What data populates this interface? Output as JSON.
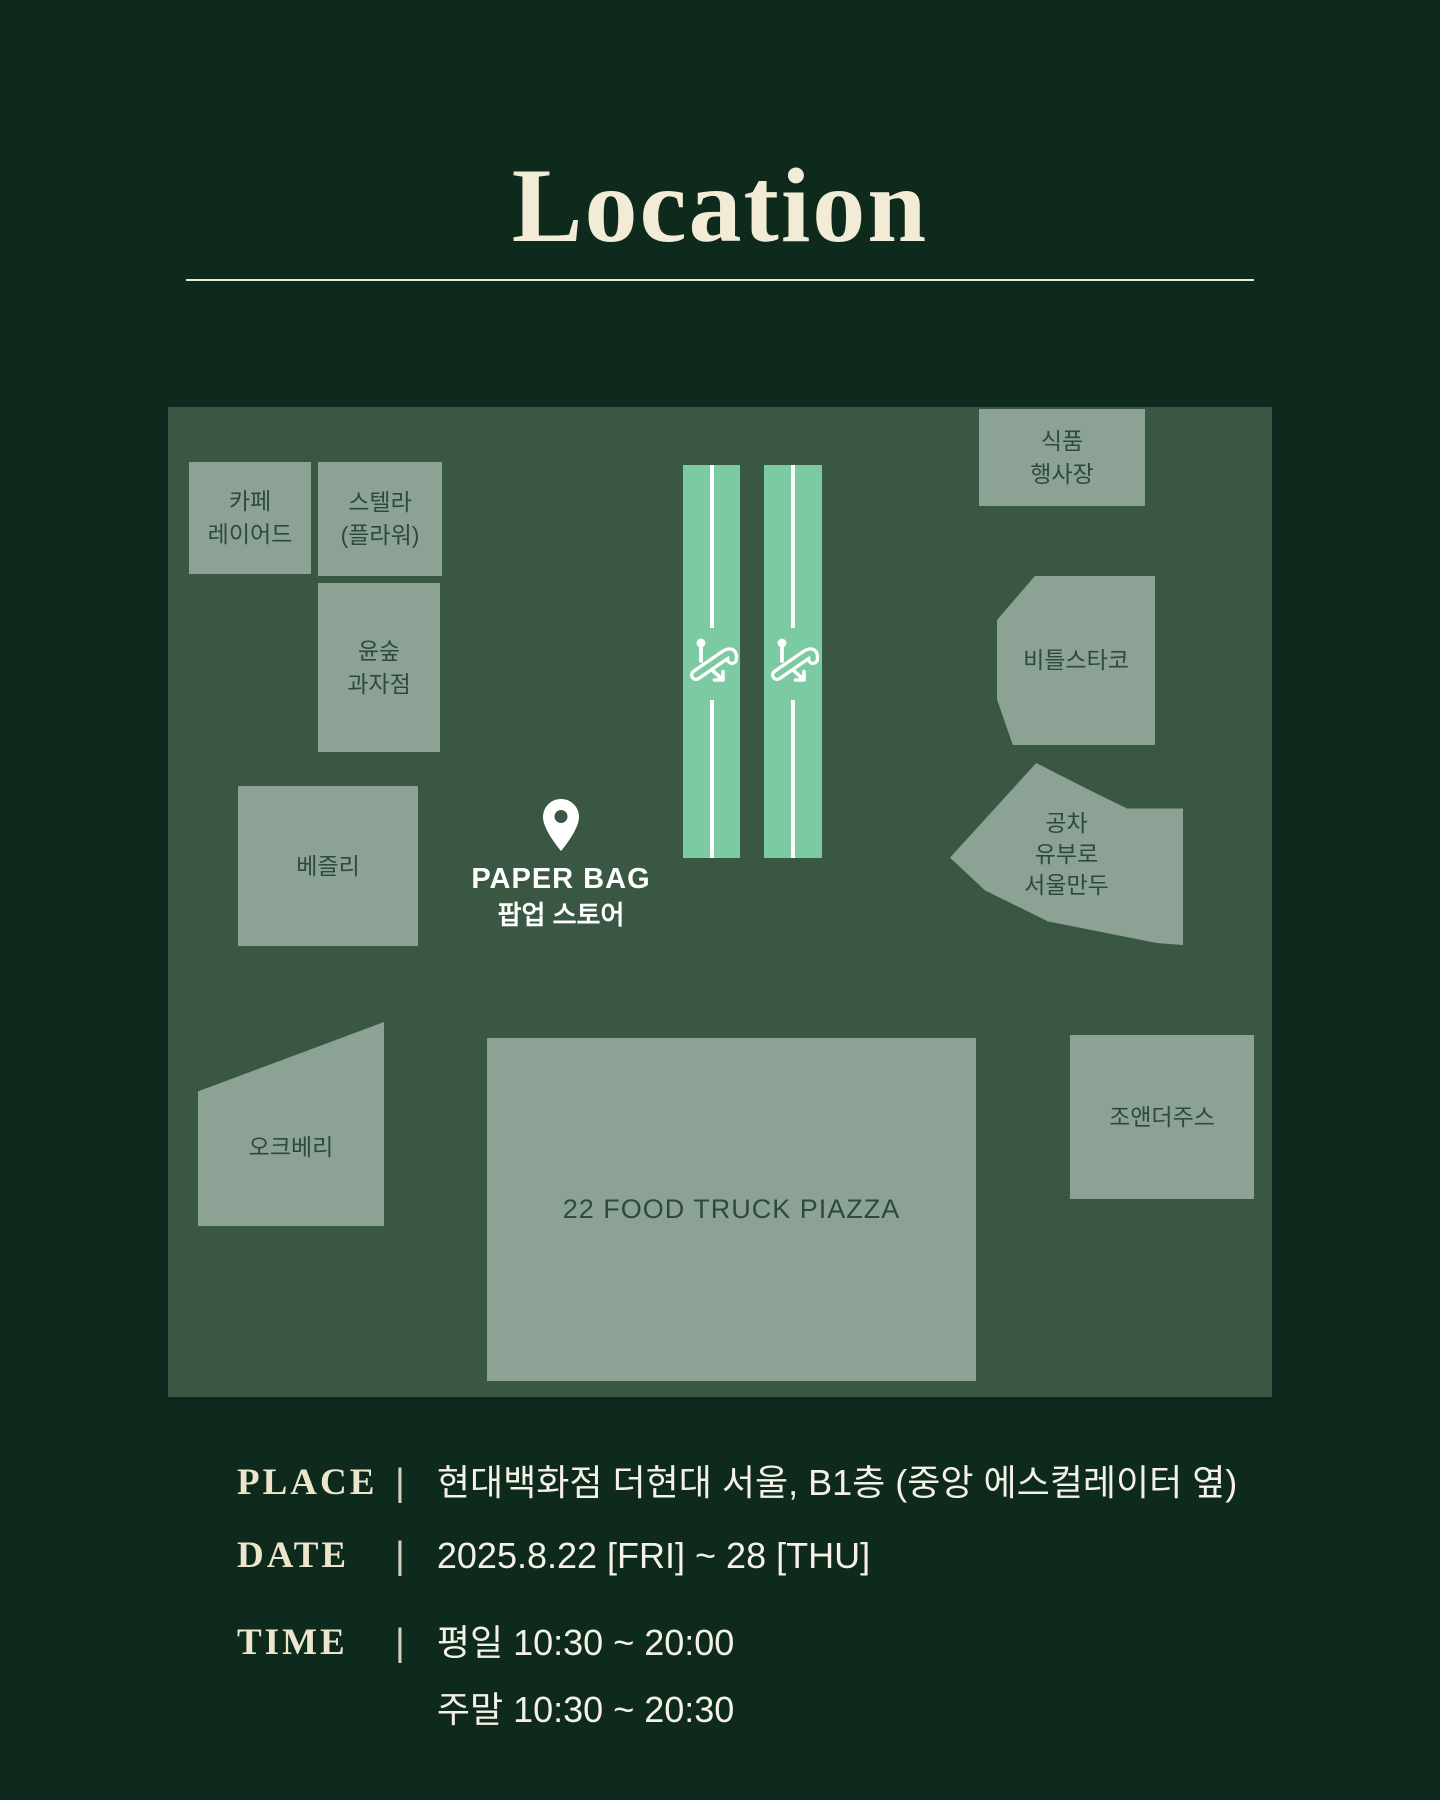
{
  "title": "Location",
  "colors": {
    "background": "#0d2a1c",
    "map_background": "#3a5744",
    "block_fill": "#8ba295",
    "block_text": "#2e4a3a",
    "escalator_fill": "#7ccaa1",
    "title_cream": "#f2ecd6",
    "info_text": "#f5f1e6"
  },
  "map": {
    "blocks": [
      {
        "id": "cafe-layered",
        "label": "카페\n레이어드"
      },
      {
        "id": "stella-flower",
        "label": "스텔라\n(플라워)"
      },
      {
        "id": "yoonsoop-bakery",
        "label": "윤숲\n과자점"
      },
      {
        "id": "bezzly",
        "label": "베즐리"
      },
      {
        "id": "oakberry",
        "label": "오크베리"
      },
      {
        "id": "food-event-hall",
        "label": "식품\n행사장"
      },
      {
        "id": "beetles-taco",
        "label": "비틀스타코"
      },
      {
        "id": "gongcha-mandu",
        "label": "공차\n유부로\n서울만두"
      },
      {
        "id": "joe-and-the-juice",
        "label": "조앤더주스"
      },
      {
        "id": "food-truck-piazza",
        "label": "22 FOOD TRUCK PIAZZA"
      }
    ],
    "escalators": {
      "icon": "escalator-icon",
      "count": 2
    },
    "popup_store": {
      "pin_icon": "location-pin-icon",
      "name": "PAPER BAG",
      "subtitle": "팝업 스토어"
    }
  },
  "info": {
    "rows": [
      {
        "label": "PLACE",
        "separator": "|",
        "value": "현대백화점 더현대 서울, B1층 (중앙 에스컬레이터 옆)"
      },
      {
        "label": "DATE",
        "separator": "|",
        "value": "2025.8.22 [FRI] ~ 28 [THU]"
      },
      {
        "label": "TIME",
        "separator": "|",
        "lines": [
          "평일  10:30 ~ 20:00",
          "주말  10:30 ~ 20:30"
        ]
      }
    ]
  }
}
